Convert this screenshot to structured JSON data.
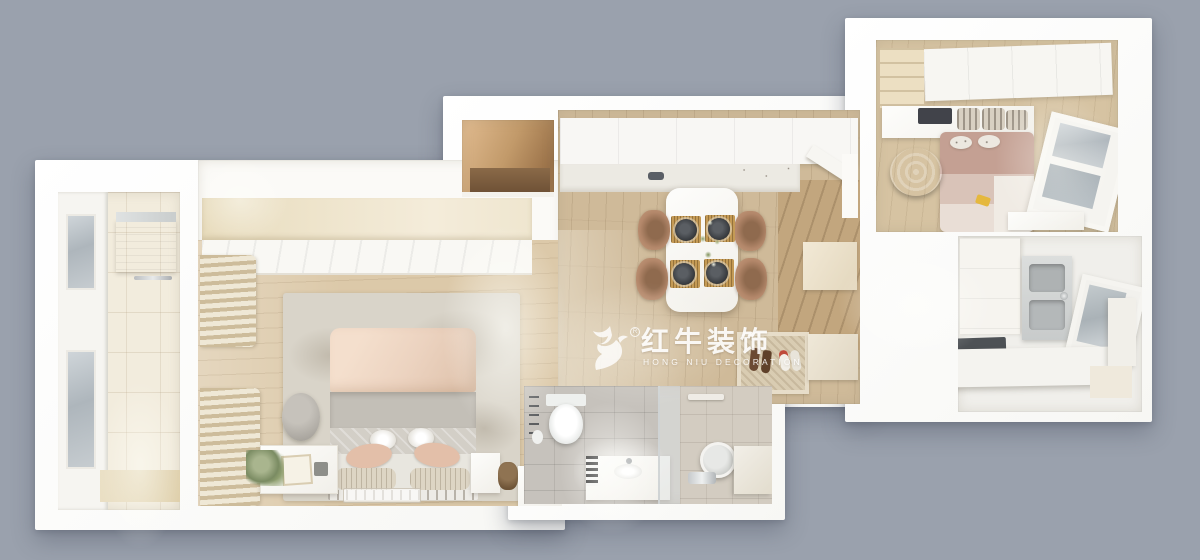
{
  "scene": {
    "description_label": "3d-apartment-floor-plan-render",
    "background_color": "#9aa1ad"
  },
  "watermark": {
    "logo": "bull-logo",
    "registered_symbol": "R",
    "title": "红牛装饰",
    "subtitle": "HONG NIU DECORATION",
    "color": "#ffffff"
  },
  "palette": {
    "background": "#9aa1ad",
    "wall": "#f7f7f4",
    "wood_dining": "#cfba99",
    "wood_bedroom": "#dcc9a9",
    "wood_entry": "#c2a67e",
    "wardrobe_beige": "#e8dcbd",
    "curtain_beige": "#cdbc9b",
    "rug": "#d9d4c9",
    "bed_duvet": "#ecd3c0",
    "bed_blanket": "#c3bfb7",
    "bed2_mauve": "#c4a093",
    "chair_tan": "#b3876a",
    "plate_dark": "#33363a",
    "tile_cream": "#f2ecdd",
    "bath_tile": "#c6c2bc",
    "bath_tile_warm": "#d3ccc1",
    "glass": "#aeb6bc",
    "hob": "#4d5155",
    "counter_white": "#f4f3ef",
    "mat_beige": "#d9ccb2",
    "watermark_color": "#ffffff"
  }
}
